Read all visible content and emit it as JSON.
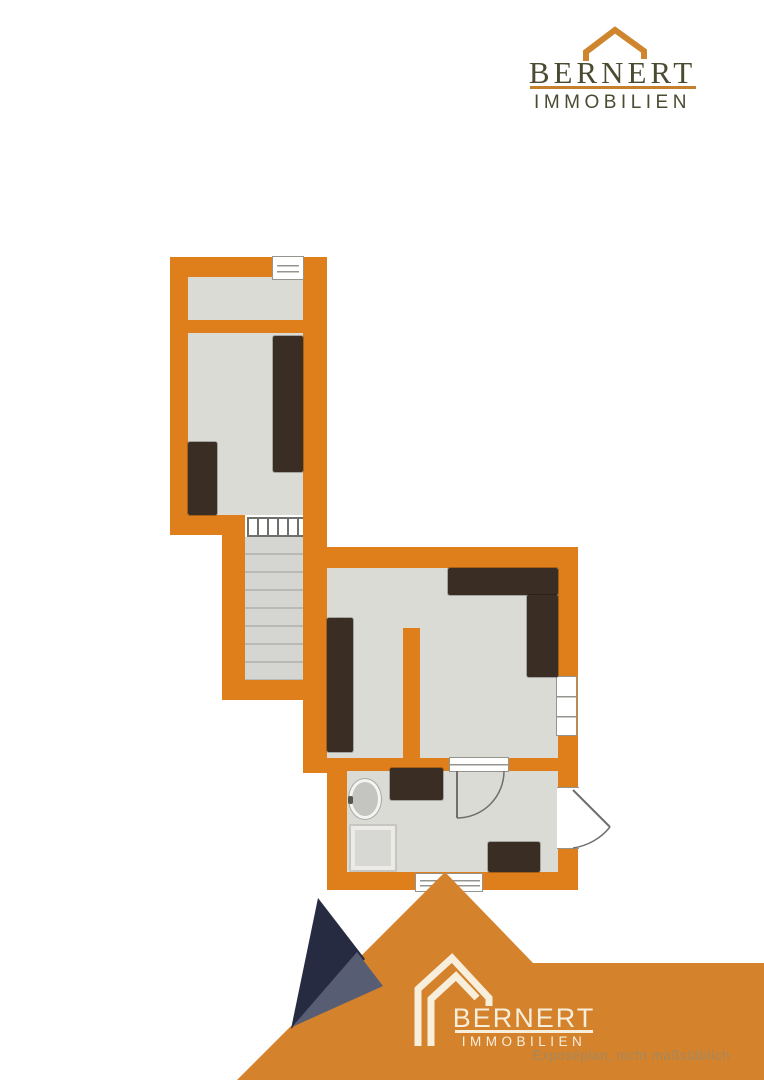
{
  "brand": {
    "name": "BERNERT",
    "subtitle": "IMMOBILIEN"
  },
  "footer": {
    "brand_name": "BERNERT",
    "brand_subtitle": "IMMOBILIEN",
    "disclaimer": "Exposéplan, nicht maßstäblich"
  },
  "colors": {
    "wall": "#de7f1b",
    "floor": "#dbdbd6",
    "tread": "#d5d5d1",
    "treadline": "#b9b9b5",
    "furn": "#3a2d23",
    "frame": "#95958f",
    "mountain": "#d5822d",
    "navy": "#262b42",
    "slate": "#575d73",
    "olive": "#4b4b32",
    "logoline": "#c5802d",
    "roof": "#cf852e",
    "cream": "#f7efdc",
    "disclaim": "#a3885e"
  },
  "floorplan": {
    "type": "floor-plan",
    "rooms": [
      "upper-small-room",
      "upper-large-room",
      "staircase",
      "living-room",
      "bathroom"
    ],
    "fixtures": [
      "sink",
      "shower"
    ],
    "furniture_count": 7,
    "windows_count": 4,
    "doors_count": 2
  }
}
